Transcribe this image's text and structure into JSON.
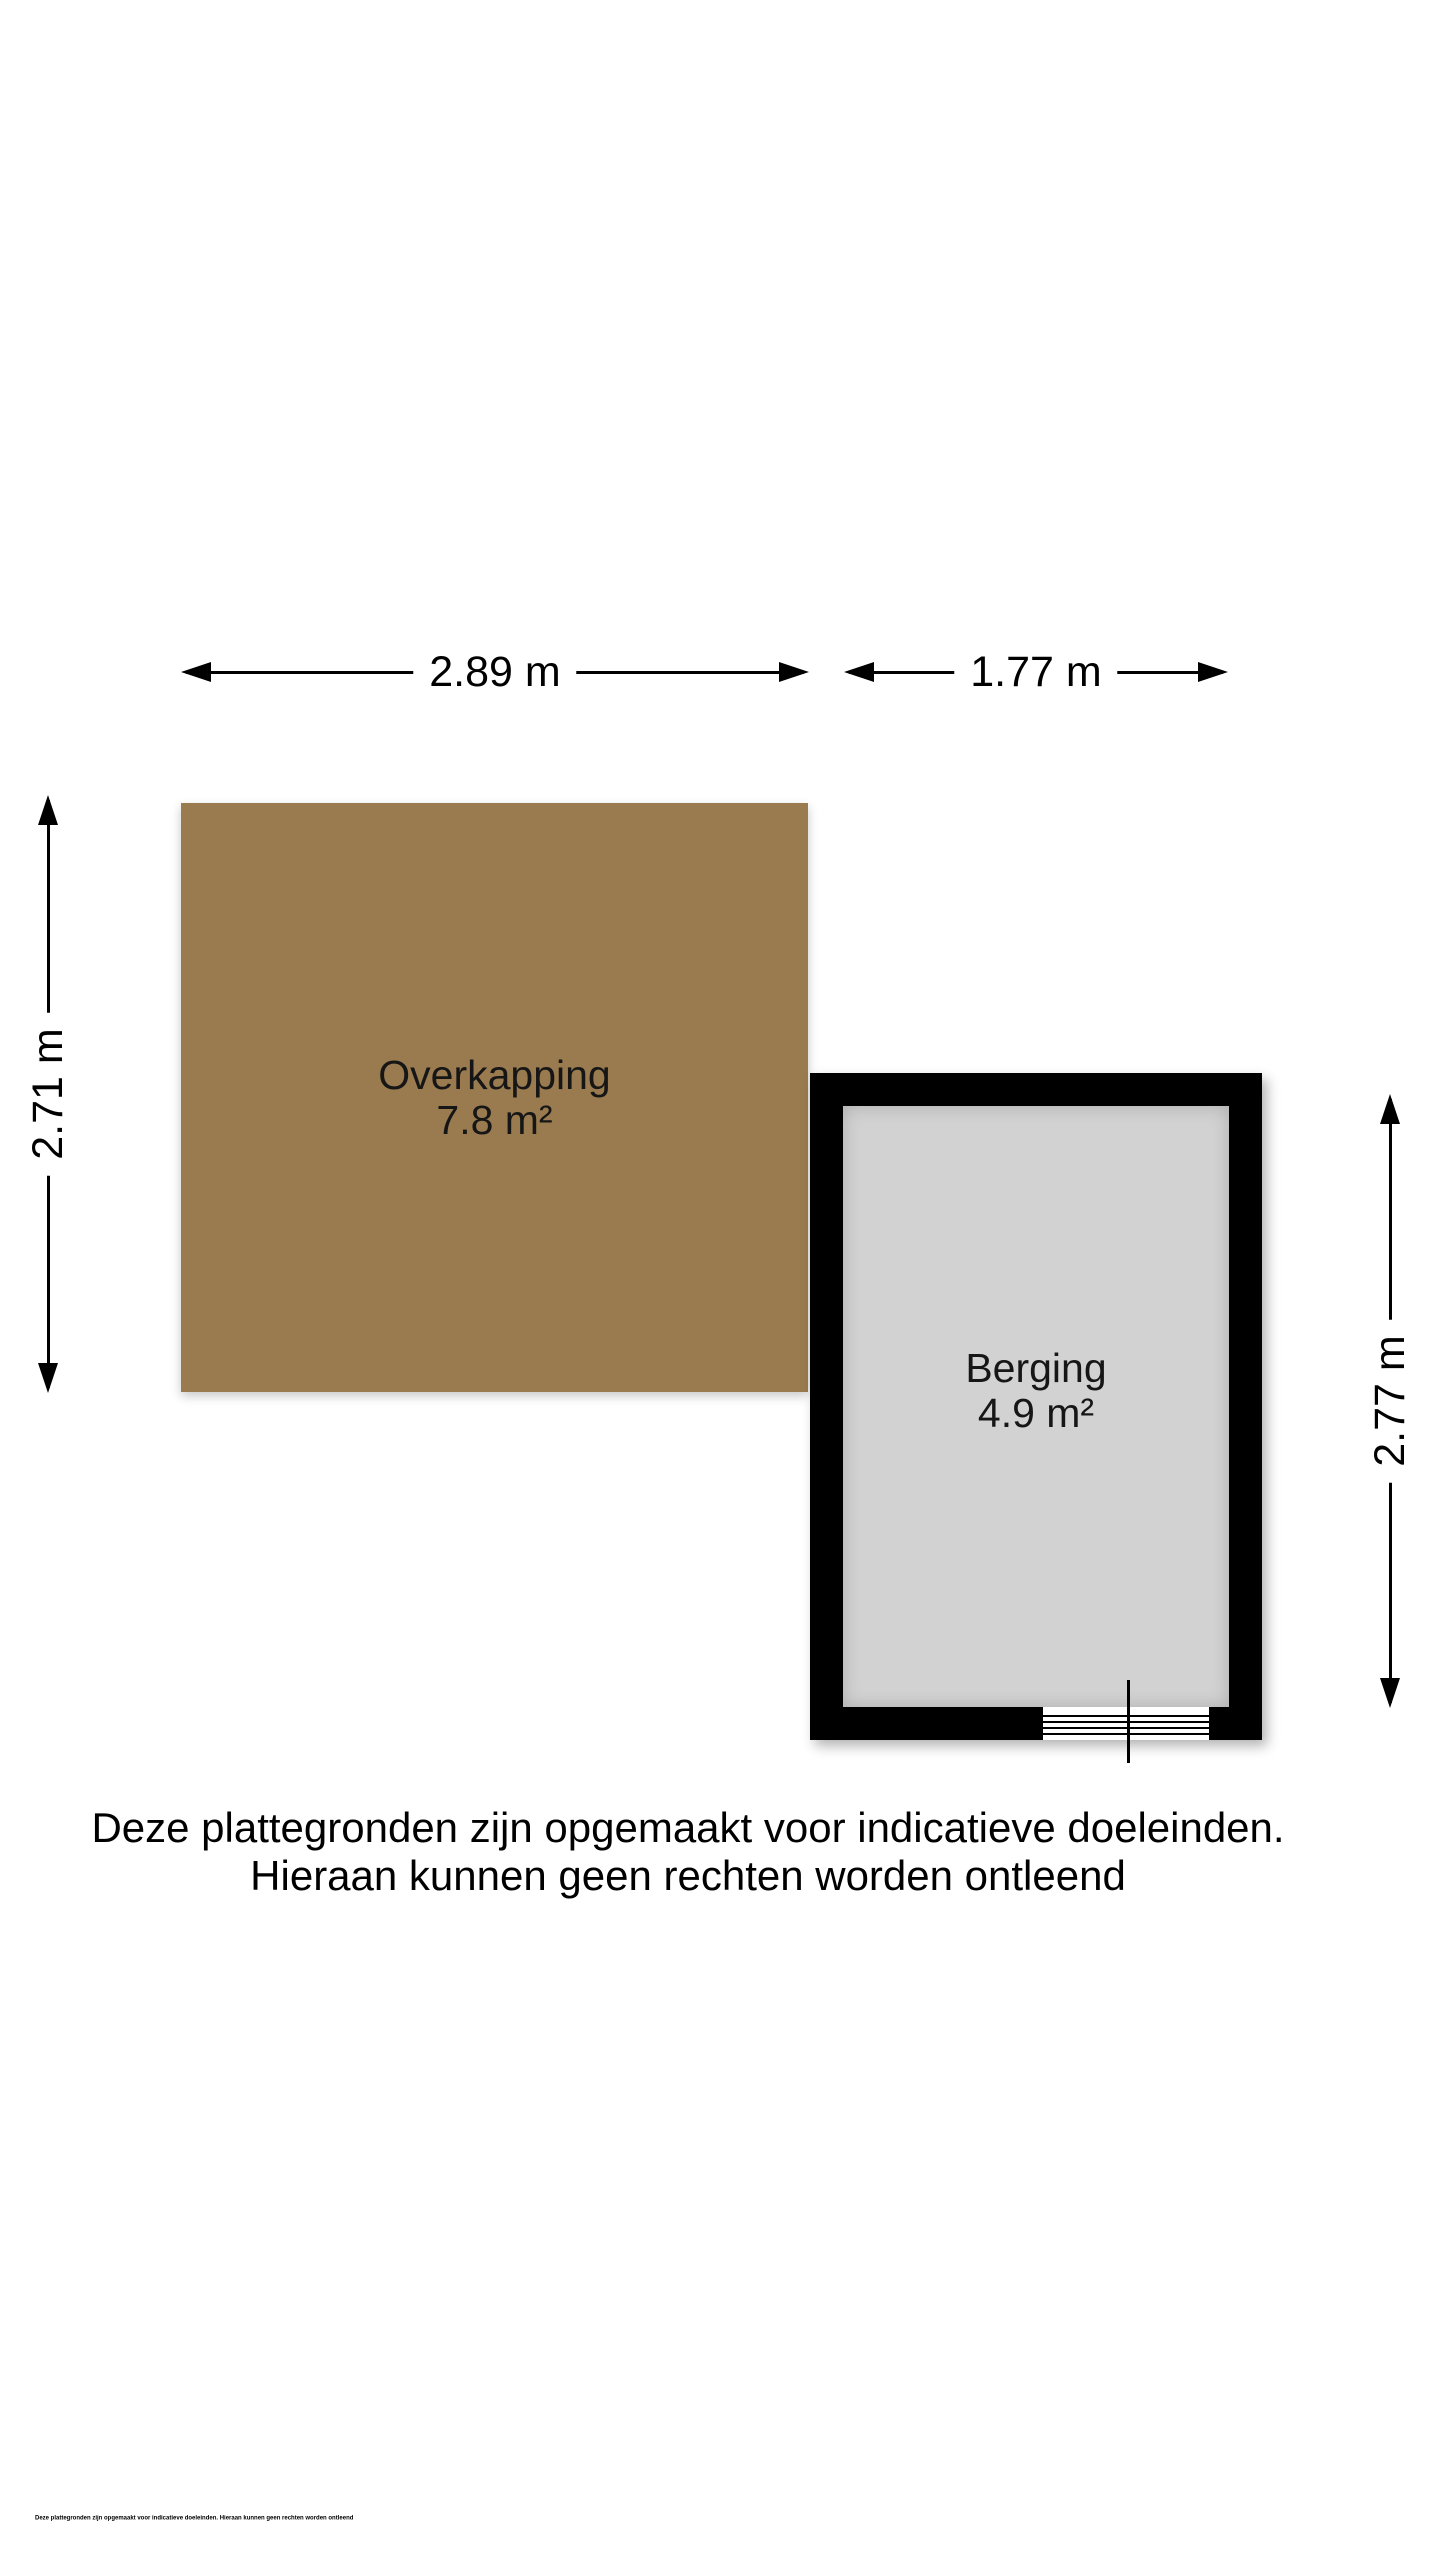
{
  "page": {
    "background": "#ffffff"
  },
  "colors": {
    "overkapping_fill": "#9a7b4f",
    "berging_floor": "#d2d2d2",
    "wall": "#000000",
    "dimension_line": "#000000",
    "text": "#000000"
  },
  "dimensions": {
    "overkapping_width": "2.89 m",
    "berging_width": "1.77 m",
    "overkapping_height": "2.71 m",
    "berging_height": "2.77 m"
  },
  "rooms": {
    "overkapping": {
      "label": "Overkapping",
      "area": "7.8 m²"
    },
    "berging": {
      "label": "Berging",
      "area": "4.9 m²"
    }
  },
  "disclaimer": {
    "line1": "Deze plattegronden zijn opgemaakt voor indicatieve doeleinden.",
    "line2": "Hieraan kunnen geen rechten worden ontleend"
  },
  "fine_print": "Deze plattegronden zijn opgemaakt voor indicatieve doeleinden. Hieraan kunnen geen rechten worden ontleend"
}
